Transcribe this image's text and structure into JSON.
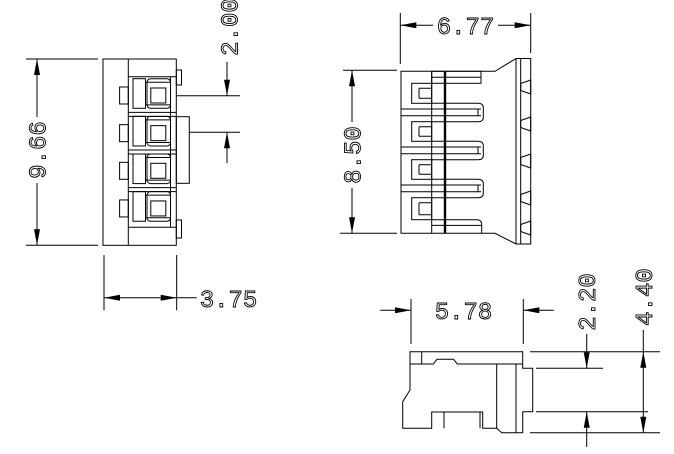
{
  "drawing": {
    "background_color": "#ffffff",
    "line_color": "#000000",
    "views": {
      "front": {
        "label": "front-view-4-position-connector",
        "dimensions": {
          "height": "9.66",
          "pitch": "2.00",
          "width": "3.75"
        }
      },
      "side": {
        "label": "side-view",
        "dimensions": {
          "width": "6.77",
          "height": "8.50"
        }
      },
      "bottom": {
        "label": "bottom-view",
        "dimensions": {
          "width": "5.78",
          "step_height": "2.20",
          "overall_height": "4.40"
        }
      }
    }
  }
}
